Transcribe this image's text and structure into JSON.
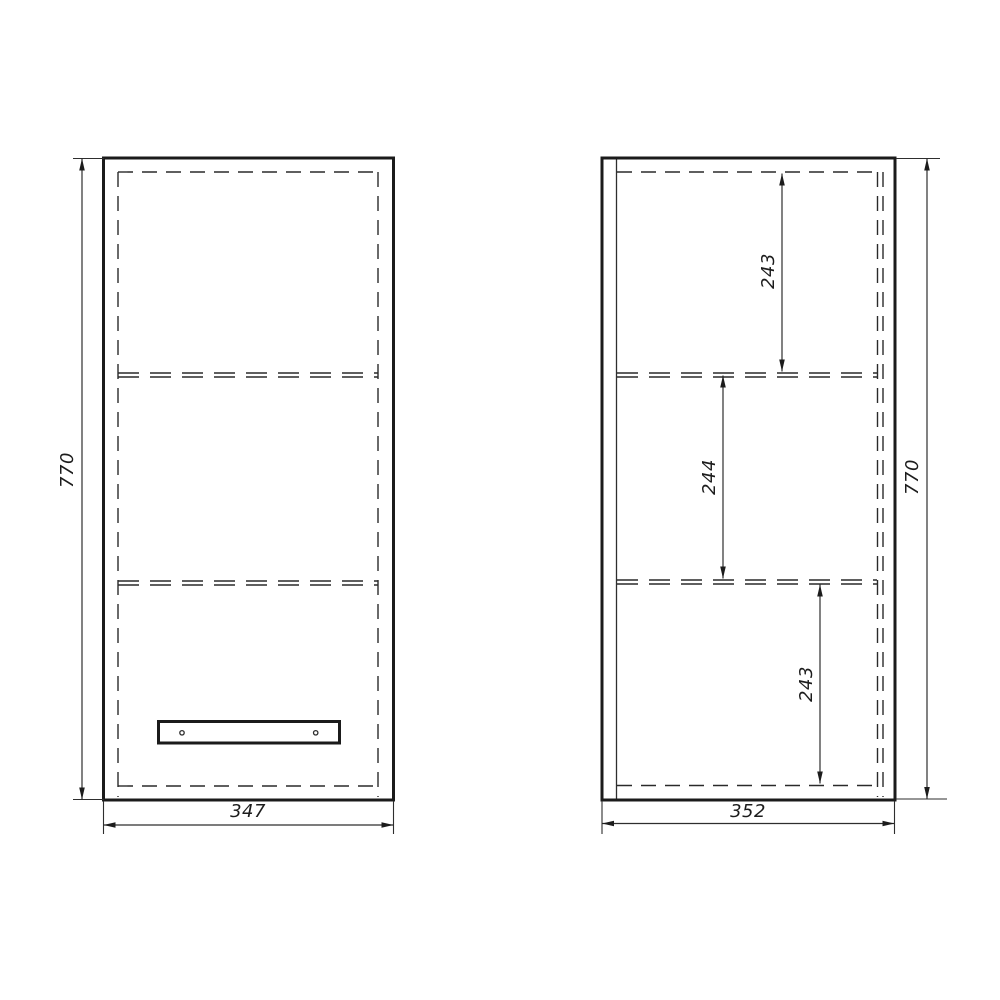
{
  "drawing": {
    "type": "furniture-cabinet-technical-drawing",
    "front_view": {
      "height": "770",
      "width": "347"
    },
    "side_view": {
      "section_top": "243",
      "section_middle": "244",
      "section_bottom": "243",
      "height": "770",
      "width": "352"
    },
    "colors": {
      "line": "#1b1b1b",
      "background": "#ffffff"
    }
  }
}
